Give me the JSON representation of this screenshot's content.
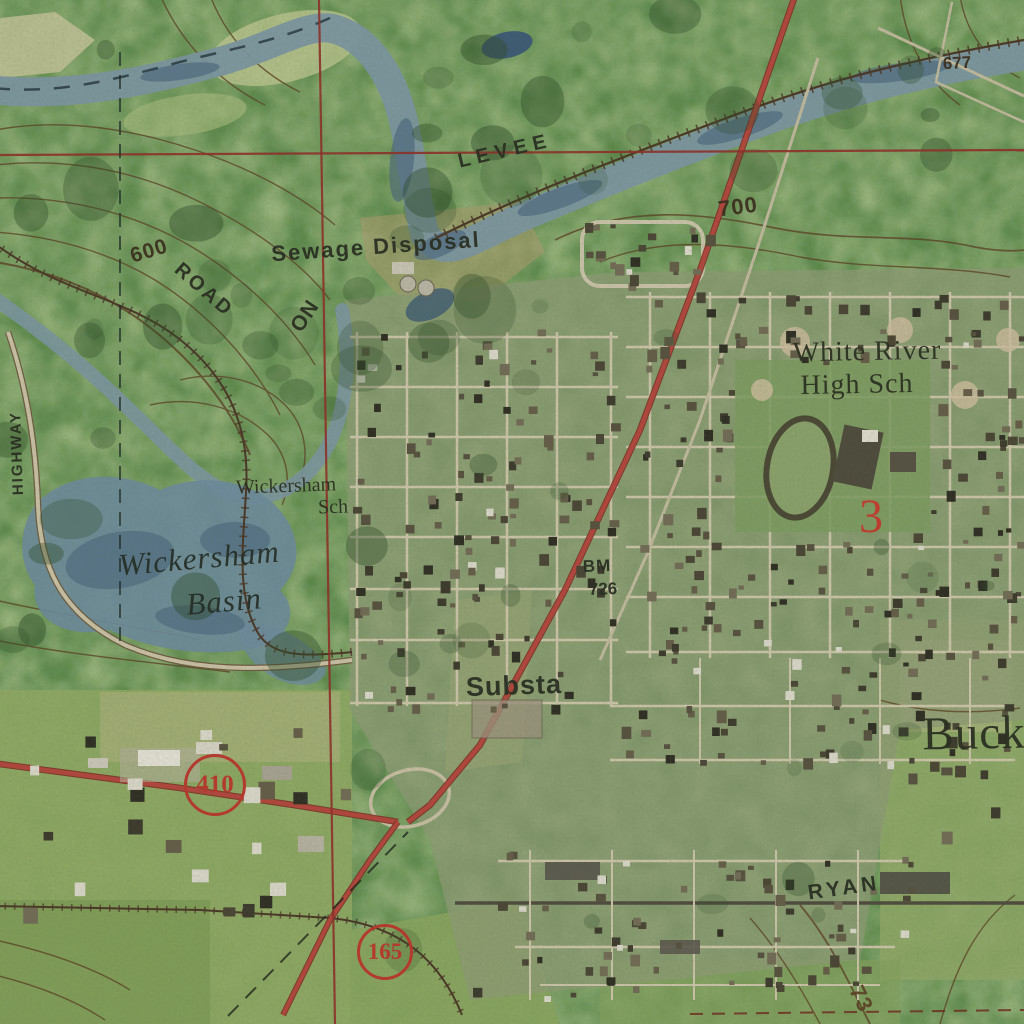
{
  "map": {
    "description": "USGS-style topographic map over aerial imagery, town on river with levee",
    "colors": {
      "forest": "#5b8747",
      "field": "#9fb26b",
      "water": "#7b95a0",
      "deep_water": "#45617a",
      "road_minor": "#cbc3a8",
      "highway_red": "#b2453c",
      "grid_red": "#8e2f28",
      "contour_brown": "#5d4326",
      "label_dark": "#2b3023",
      "shield_red": "#b23a2e"
    }
  },
  "shields": [
    {
      "route": "410",
      "x": 215,
      "y": 785,
      "r": 31
    },
    {
      "route": "165",
      "x": 385,
      "y": 952,
      "r": 28
    }
  ],
  "benchmark": {
    "name": "BM",
    "elevation": "726"
  },
  "spot_elevation": "677",
  "contour_elevations": [
    "600",
    "700",
    "73"
  ],
  "labels": [
    {
      "id": "levee",
      "text": "LEVEE",
      "x": 505,
      "y": 151,
      "rot": -13,
      "size": 20,
      "ls": 6,
      "cls": "lbl-sans"
    },
    {
      "id": "sewage",
      "text": "Sewage Disposal",
      "x": 376,
      "y": 247,
      "rot": -4,
      "size": 22,
      "ls": 2,
      "cls": "lbl-sans"
    },
    {
      "id": "c600",
      "text": "600",
      "x": 149,
      "y": 251,
      "rot": -17,
      "size": 21,
      "ls": 1,
      "cls": "lbl-contour"
    },
    {
      "id": "c700",
      "text": "700",
      "x": 738,
      "y": 207,
      "rot": -7,
      "size": 22,
      "ls": 1,
      "cls": "lbl-contour"
    },
    {
      "id": "spot677",
      "text": "677",
      "x": 957,
      "y": 63,
      "rot": -3,
      "size": 17,
      "ls": 0,
      "cls": "lbl-contour"
    },
    {
      "id": "road",
      "text": "ROAD",
      "x": 204,
      "y": 290,
      "rot": 41,
      "size": 20,
      "ls": 3,
      "cls": "lbl-sans"
    },
    {
      "id": "on",
      "text": "ON",
      "x": 305,
      "y": 316,
      "rot": -56,
      "size": 21,
      "ls": 1,
      "cls": "lbl-sans"
    },
    {
      "id": "highway",
      "text": "HIGHWAY",
      "x": 17,
      "y": 453,
      "rot": -92,
      "size": 15,
      "ls": 2,
      "cls": "lbl-sans"
    },
    {
      "id": "wsch1",
      "text": "Wickersham",
      "x": 286,
      "y": 486,
      "rot": -2,
      "size": 20,
      "ls": 0,
      "cls": "lbl-serif"
    },
    {
      "id": "wsch2",
      "text": "Sch",
      "x": 333,
      "y": 507,
      "rot": -2,
      "size": 20,
      "ls": 0,
      "cls": "lbl-serif"
    },
    {
      "id": "basin1",
      "text": "Wickersham",
      "x": 199,
      "y": 558,
      "rot": -5,
      "size": 31,
      "ls": 1,
      "cls": "lbl-italic"
    },
    {
      "id": "basin2",
      "text": "Basin",
      "x": 224,
      "y": 601,
      "rot": -5,
      "size": 31,
      "ls": 1,
      "cls": "lbl-italic"
    },
    {
      "id": "whs1",
      "text": "White River",
      "x": 867,
      "y": 352,
      "rot": -1,
      "size": 28,
      "ls": 1,
      "cls": "lbl-serif"
    },
    {
      "id": "whs2",
      "text": "High Sch",
      "x": 857,
      "y": 385,
      "rot": -1,
      "size": 28,
      "ls": 1,
      "cls": "lbl-serif"
    },
    {
      "id": "bm1",
      "text": "BM",
      "x": 597,
      "y": 566,
      "rot": -2,
      "size": 17,
      "ls": 1,
      "cls": "lbl-sans"
    },
    {
      "id": "bm2",
      "text": "726",
      "x": 603,
      "y": 589,
      "rot": -2,
      "size": 17,
      "ls": 0,
      "cls": "lbl-sans"
    },
    {
      "id": "substa",
      "text": "Substa",
      "x": 514,
      "y": 686,
      "rot": -2,
      "size": 27,
      "ls": 1,
      "cls": "lbl-sans"
    },
    {
      "id": "buck",
      "text": "Buck",
      "x": 974,
      "y": 734,
      "rot": -1,
      "size": 47,
      "ls": 1,
      "cls": "lbl-serif"
    },
    {
      "id": "sec3",
      "text": "3",
      "x": 871,
      "y": 517,
      "rot": 0,
      "size": 48,
      "ls": 0,
      "cls": "lbl-red"
    },
    {
      "id": "ryan",
      "text": "RYAN",
      "x": 844,
      "y": 888,
      "rot": -8,
      "size": 21,
      "ls": 4,
      "cls": "lbl-sans"
    },
    {
      "id": "c73",
      "text": "73",
      "x": 861,
      "y": 999,
      "rot": 64,
      "size": 22,
      "ls": 1,
      "cls": "lbl-brown"
    }
  ]
}
